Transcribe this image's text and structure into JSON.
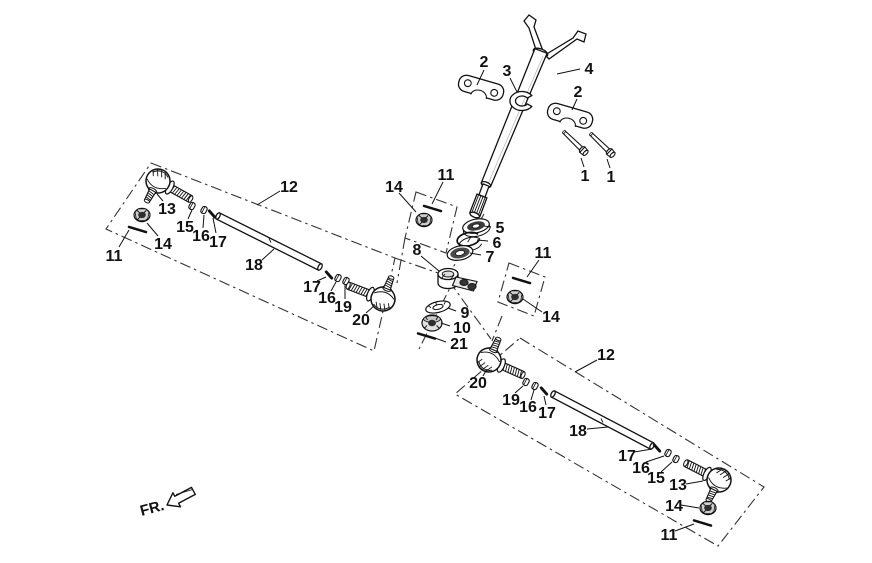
{
  "figure": {
    "fr_label": "FR."
  },
  "colors": {
    "line": "#111111",
    "background": "#ffffff",
    "phantom_line": "#333333"
  },
  "callouts": [
    {
      "text": "2"
    },
    {
      "text": "3"
    },
    {
      "text": "4"
    },
    {
      "text": "2"
    },
    {
      "text": "1"
    },
    {
      "text": "1"
    },
    {
      "text": "5"
    },
    {
      "text": "6"
    },
    {
      "text": "7"
    },
    {
      "text": "8"
    },
    {
      "text": "9"
    },
    {
      "text": "10"
    },
    {
      "text": "21"
    },
    {
      "text": "11"
    },
    {
      "text": "14"
    },
    {
      "text": "11"
    },
    {
      "text": "14"
    },
    {
      "text": "12"
    },
    {
      "text": "13"
    },
    {
      "text": "14"
    },
    {
      "text": "11"
    },
    {
      "text": "15"
    },
    {
      "text": "16"
    },
    {
      "text": "17"
    },
    {
      "text": "18"
    },
    {
      "text": "17"
    },
    {
      "text": "16"
    },
    {
      "text": "19"
    },
    {
      "text": "20"
    },
    {
      "text": "12"
    },
    {
      "text": "20"
    },
    {
      "text": "19"
    },
    {
      "text": "16"
    },
    {
      "text": "17"
    },
    {
      "text": "18"
    },
    {
      "text": "17"
    },
    {
      "text": "16"
    },
    {
      "text": "15"
    },
    {
      "text": "13"
    },
    {
      "text": "14"
    },
    {
      "text": "11"
    }
  ]
}
